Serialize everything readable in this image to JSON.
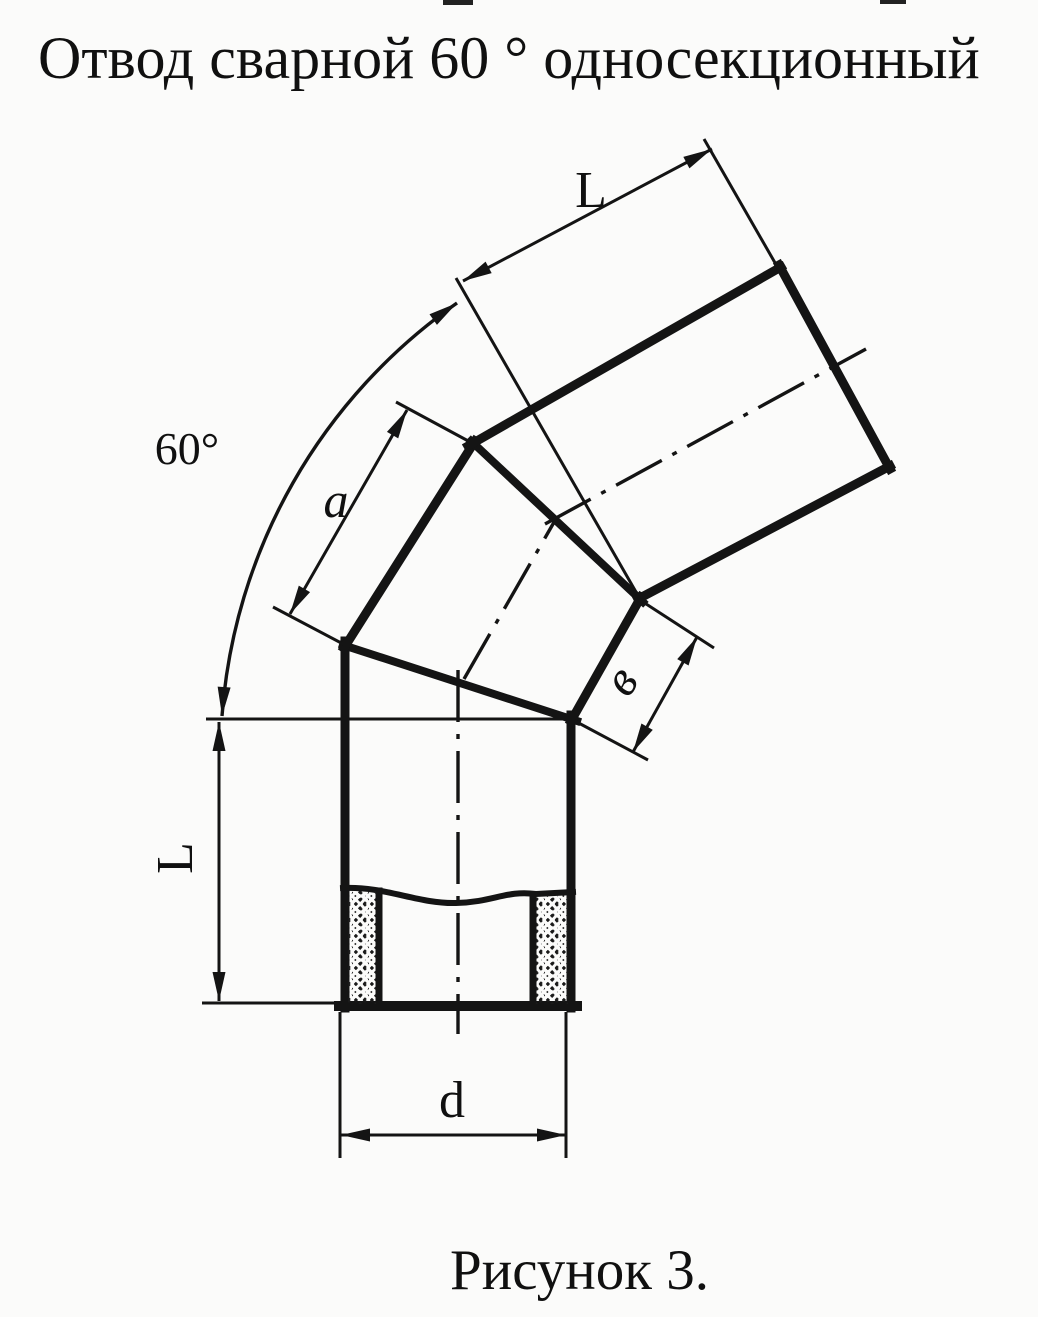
{
  "title": "Отвод сварной 60 ° односекционный",
  "figure_caption": "Рисунок 3.",
  "dimensions": {
    "angle": "60°",
    "top_arm_length": "L",
    "section_outer_width": "a",
    "section_inner_width": "в",
    "bottom_arm_length": "L",
    "diameter": "d"
  },
  "colors": {
    "ink": "#141414",
    "paper": "#fbfbfa"
  }
}
